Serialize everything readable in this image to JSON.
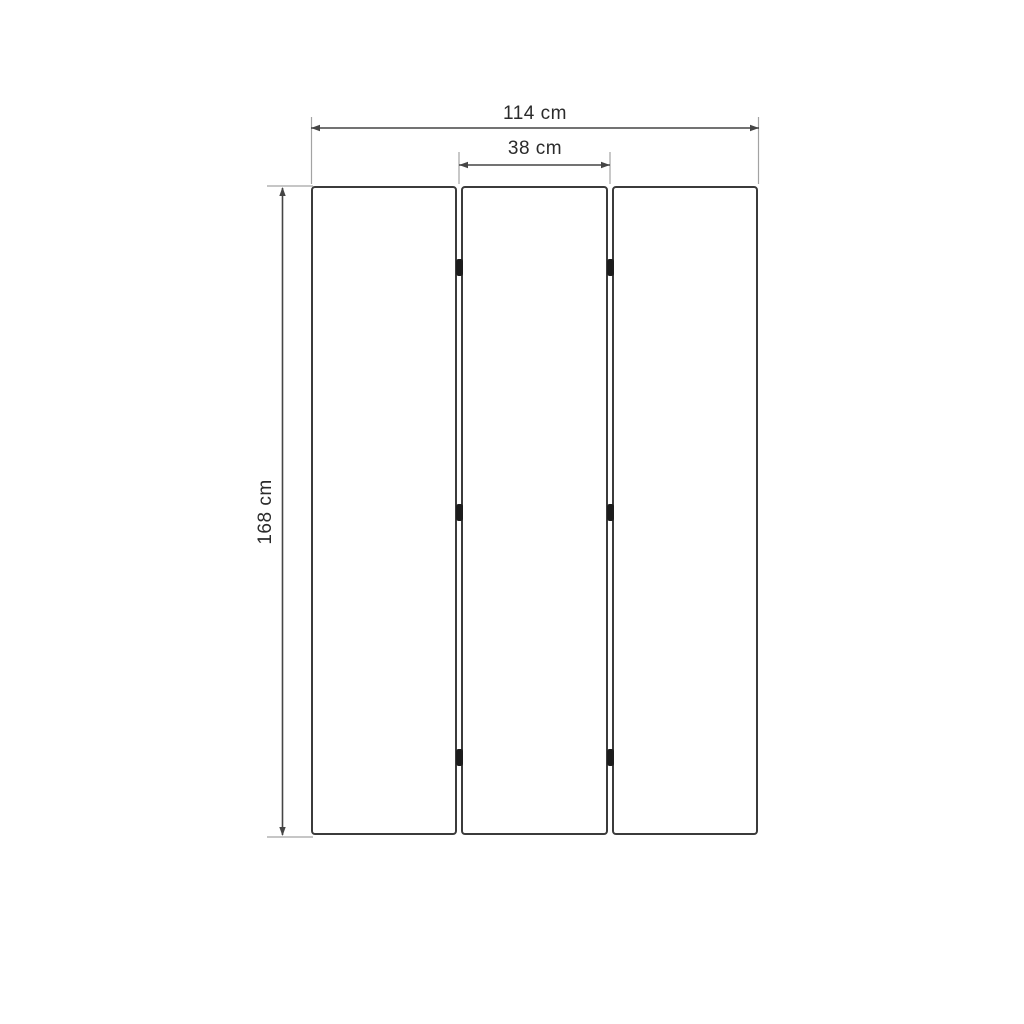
{
  "diagram": {
    "dimensions": {
      "total_width": {
        "label": "114 cm"
      },
      "panel_width": {
        "label": "38 cm"
      },
      "height": {
        "label": "168 cm"
      }
    },
    "structure": {
      "panel_count": 3,
      "gap_count": 2,
      "hinges_per_gap": 3
    },
    "colors": {
      "background": "#ffffff",
      "panel_border": "#3b3b3b",
      "dimension_line": "#454545",
      "extension_line": "#a3a3a3",
      "hinge": "#1c1c1c",
      "label_text": "#2b2b2b"
    }
  }
}
